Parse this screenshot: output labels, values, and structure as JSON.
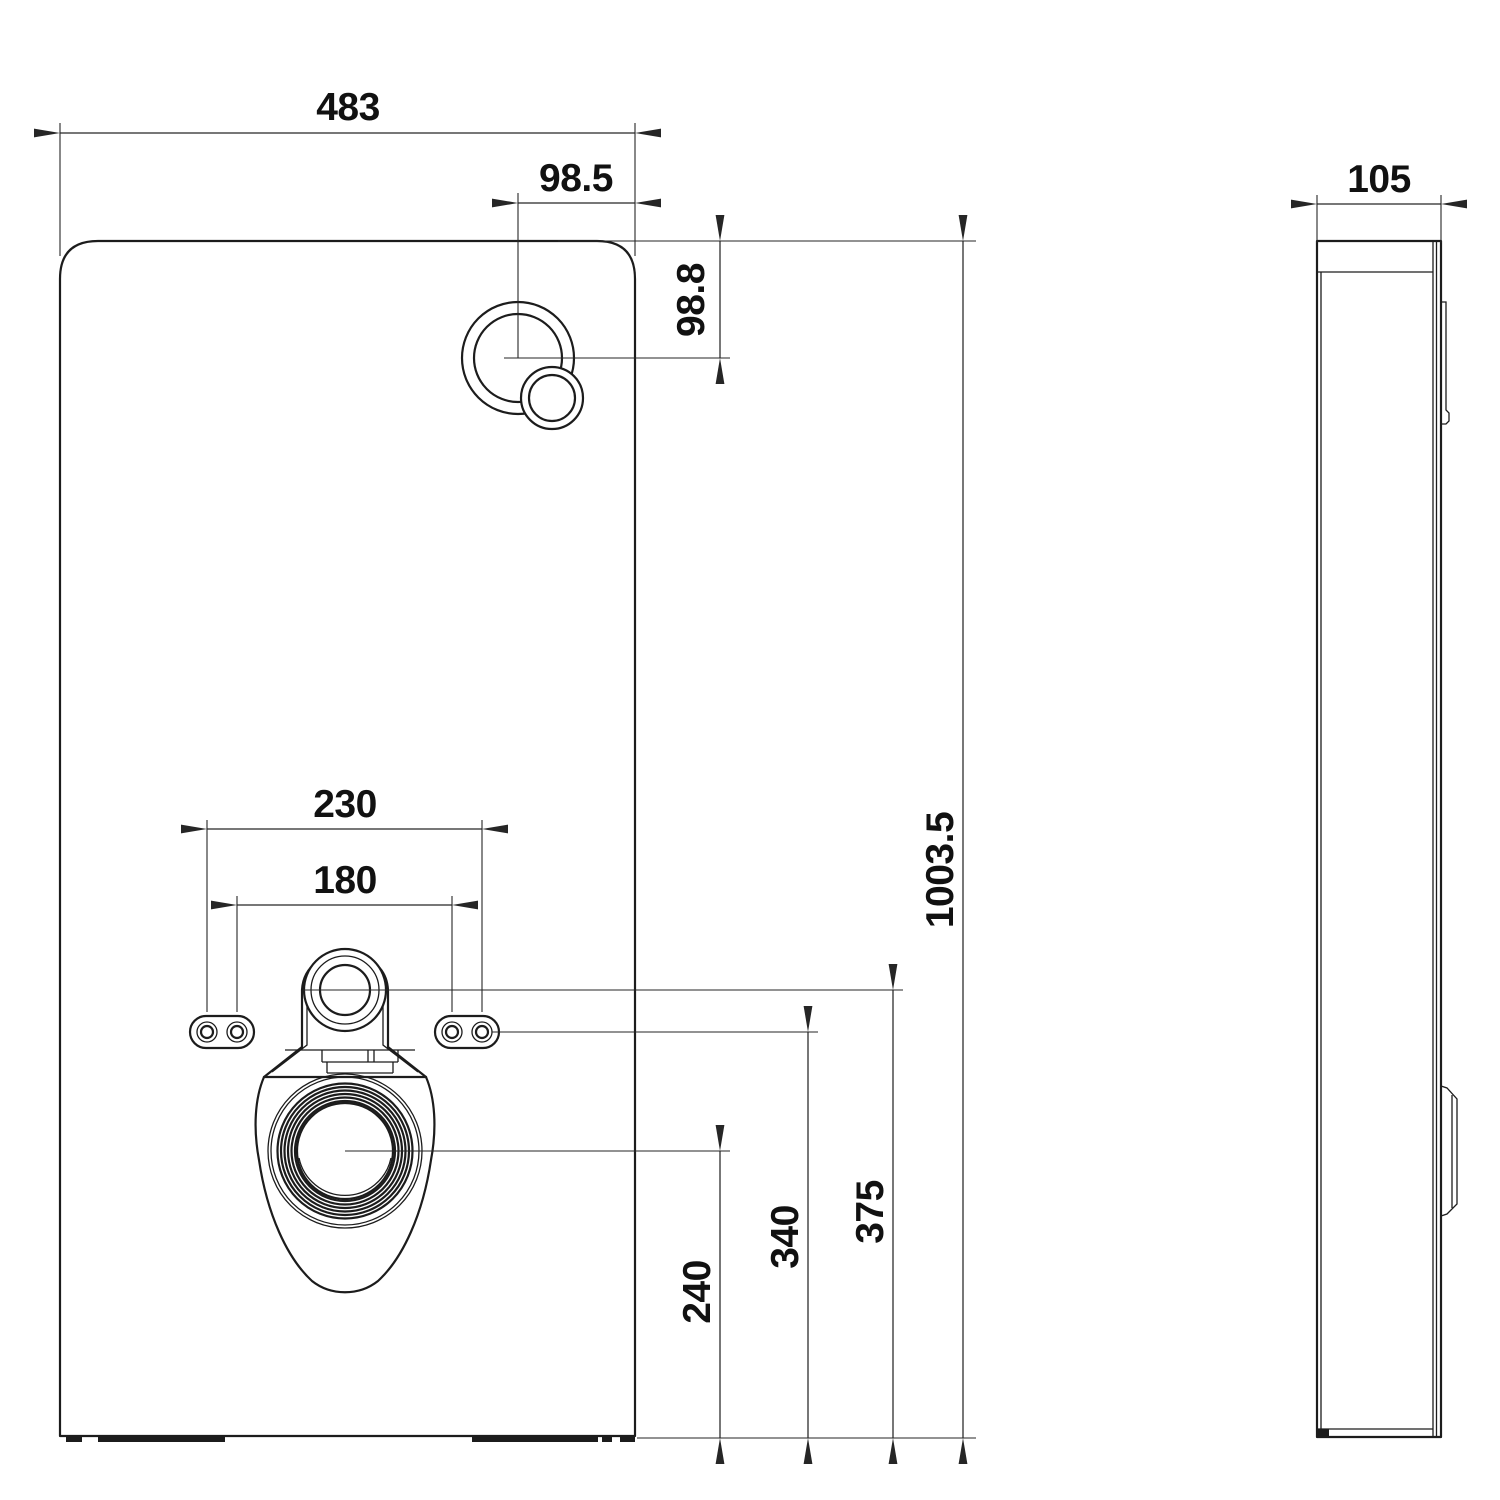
{
  "colors": {
    "background": "#ffffff",
    "line": "#1c1c1c",
    "dimension_line": "#262626",
    "text": "#111111"
  },
  "dims": {
    "width": {
      "label": "483"
    },
    "button_offset_x": {
      "label": "98.5"
    },
    "button_offset_y": {
      "label": "98.8"
    },
    "height": {
      "label": "1003.5"
    },
    "holes_outer_span": {
      "label": "230"
    },
    "holes_inner_span": {
      "label": "180"
    },
    "drain_center_height": {
      "label": "240"
    },
    "holes_center_height": {
      "label": "340"
    },
    "inlet_center_height": {
      "label": "375"
    },
    "depth": {
      "label": "105"
    }
  }
}
